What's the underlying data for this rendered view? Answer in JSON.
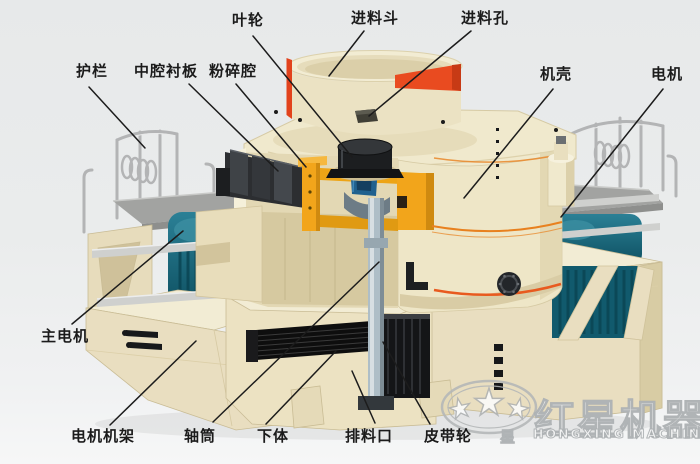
{
  "labels": {
    "impeller": "叶轮",
    "feed_hopper": "进料斗",
    "feed_hole": "进料孔",
    "guardrail": "护栏",
    "middle_cavity_liner": "中腔衬板",
    "crushing_chamber": "粉碎腔",
    "casing": "机壳",
    "motor": "电机",
    "main_motor": "主电机",
    "motor_frame": "电机机架",
    "shaft_tube": "轴筒",
    "lower_body": "下体",
    "discharge_port": "排料口",
    "belt_pulley": "皮带轮"
  },
  "watermark": {
    "brand_cn": "红星机器",
    "brand_en": "HONGXING MACHINERY",
    "star_char": "星"
  },
  "machine": {
    "part_colors": {
      "body_cream": "#efe7c8",
      "hopper_band_red": "#ea4a20",
      "impeller_mount_yellow": "#f2a51b",
      "motor_teal": "#156478",
      "shaft_gray": "#aebec7",
      "belt_black": "#141414",
      "trim_orange": "#e8811f",
      "label_text": "#1b1b1b"
    }
  }
}
